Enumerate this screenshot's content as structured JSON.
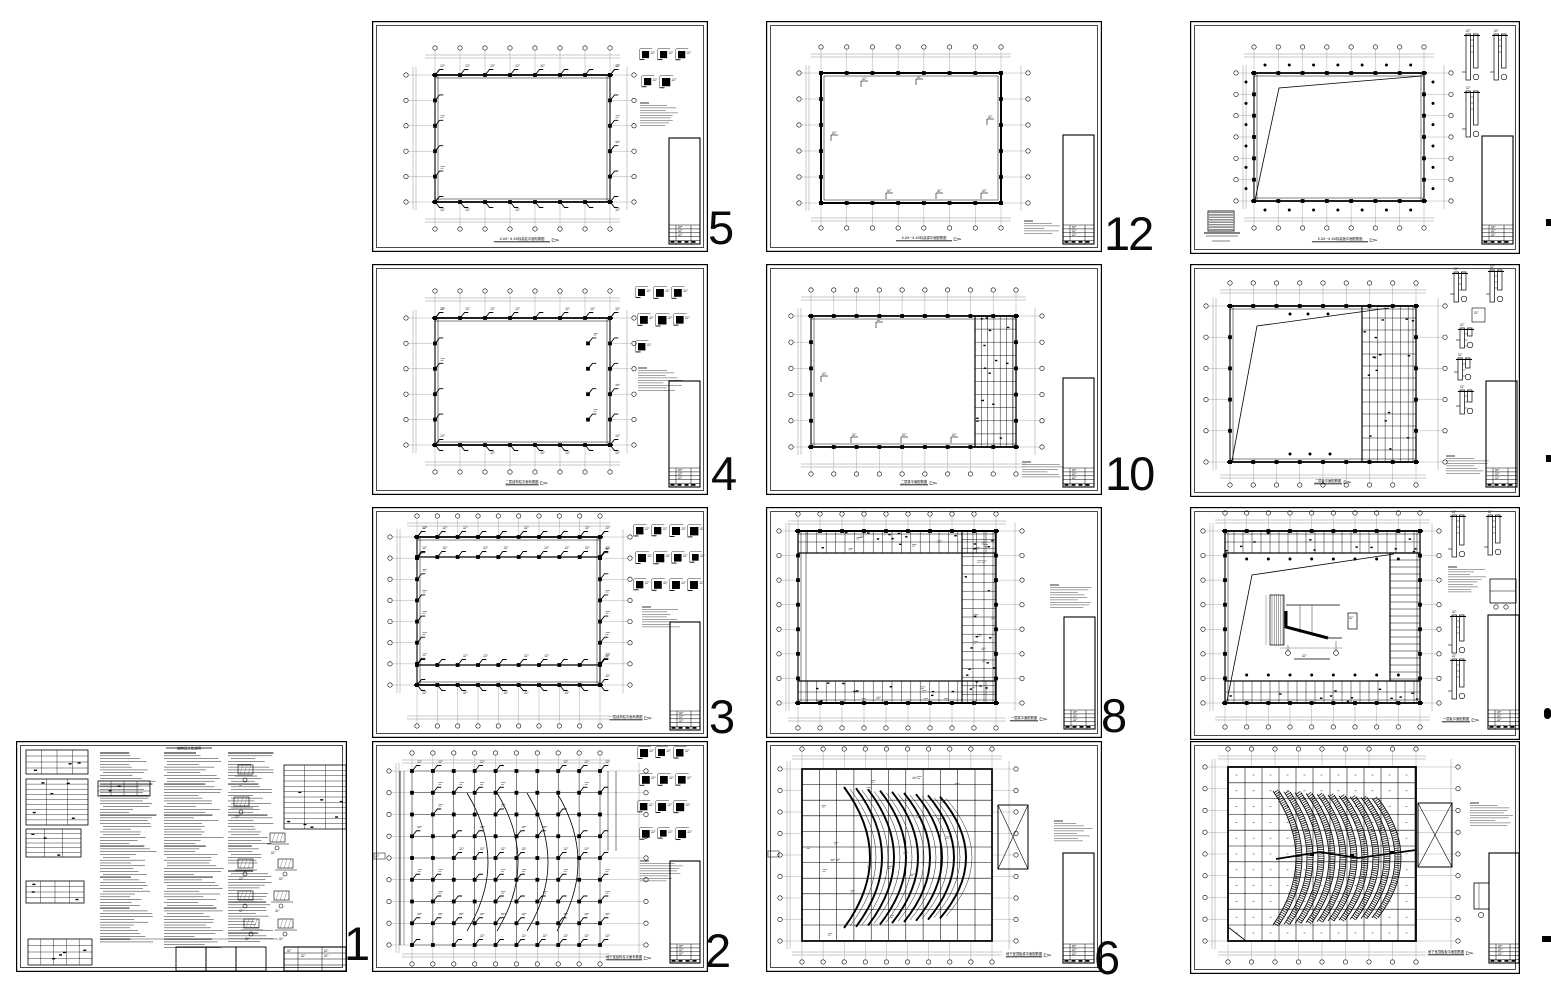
{
  "app": {
    "description": "Overview layout of a structural CAD drawing set (13 sheets with page numbers)",
    "page_background": "#ffffff",
    "ink_color": "#000000"
  },
  "sheets": [
    {
      "id": "s1",
      "page_label": "1",
      "page_label_cropped": false,
      "kind": "general structural notes sheet",
      "caption": "结构设计总说明"
    },
    {
      "id": "s5",
      "page_label": "5",
      "page_label_cropped": false,
      "kind": "column layout plan",
      "caption": "X.XX~X.XX标高柱平面布置图"
    },
    {
      "id": "s4",
      "page_label": "4",
      "page_label_cropped": false,
      "kind": "column layout plan",
      "caption": "二层结构柱平面布置图"
    },
    {
      "id": "s3",
      "page_label": "3",
      "page_label_cropped": false,
      "kind": "column layout plan",
      "caption": "一层结构柱平面布置图"
    },
    {
      "id": "s2",
      "page_label": "2",
      "page_label_cropped": false,
      "kind": "column layout plan with curved rows",
      "caption": "地下室结构柱平面布置图"
    },
    {
      "id": "s12",
      "page_label": "12",
      "page_label_cropped": false,
      "kind": "roof beam framing plan",
      "caption": "X.XX~X.XX标高梁平面配筋图"
    },
    {
      "id": "s10",
      "page_label": "10",
      "page_label_cropped": false,
      "kind": "beam framing plan with right room strip",
      "caption": "二层梁平面配筋图"
    },
    {
      "id": "s8",
      "page_label": "8",
      "page_label_cropped": false,
      "kind": "beam framing plan, perimeter rooms",
      "caption": "一层梁平面配筋图"
    },
    {
      "id": "s6",
      "page_label": "6",
      "page_label_cropped": false,
      "kind": "beam framing plan with fan-shaped beams",
      "caption": "地下室顶板梁平面配筋图"
    },
    {
      "id": "r1",
      "page_label": "",
      "page_label_cropped": true,
      "kind": "roof slab plan with diagonal line and wall sections",
      "caption": "X.XX~X.XX标高板平面配筋图"
    },
    {
      "id": "r2",
      "page_label": "",
      "page_label_cropped": true,
      "kind": "slab plan with diagonal line and right strip",
      "caption": "二层板平面配筋图"
    },
    {
      "id": "r3",
      "page_label": "",
      "page_label_cropped": true,
      "kind": "slab plan with stair detail",
      "caption": "一层板平面配筋图"
    },
    {
      "id": "r4",
      "page_label": "",
      "page_label_cropped": true,
      "kind": "slab plan with hatched fan-shaped tiers",
      "caption": "地下室顶板板平面配筋图"
    }
  ],
  "right_edge_partial_labels": {
    "count": 4,
    "note": "page numbers of 4th column cut off at image edge"
  }
}
